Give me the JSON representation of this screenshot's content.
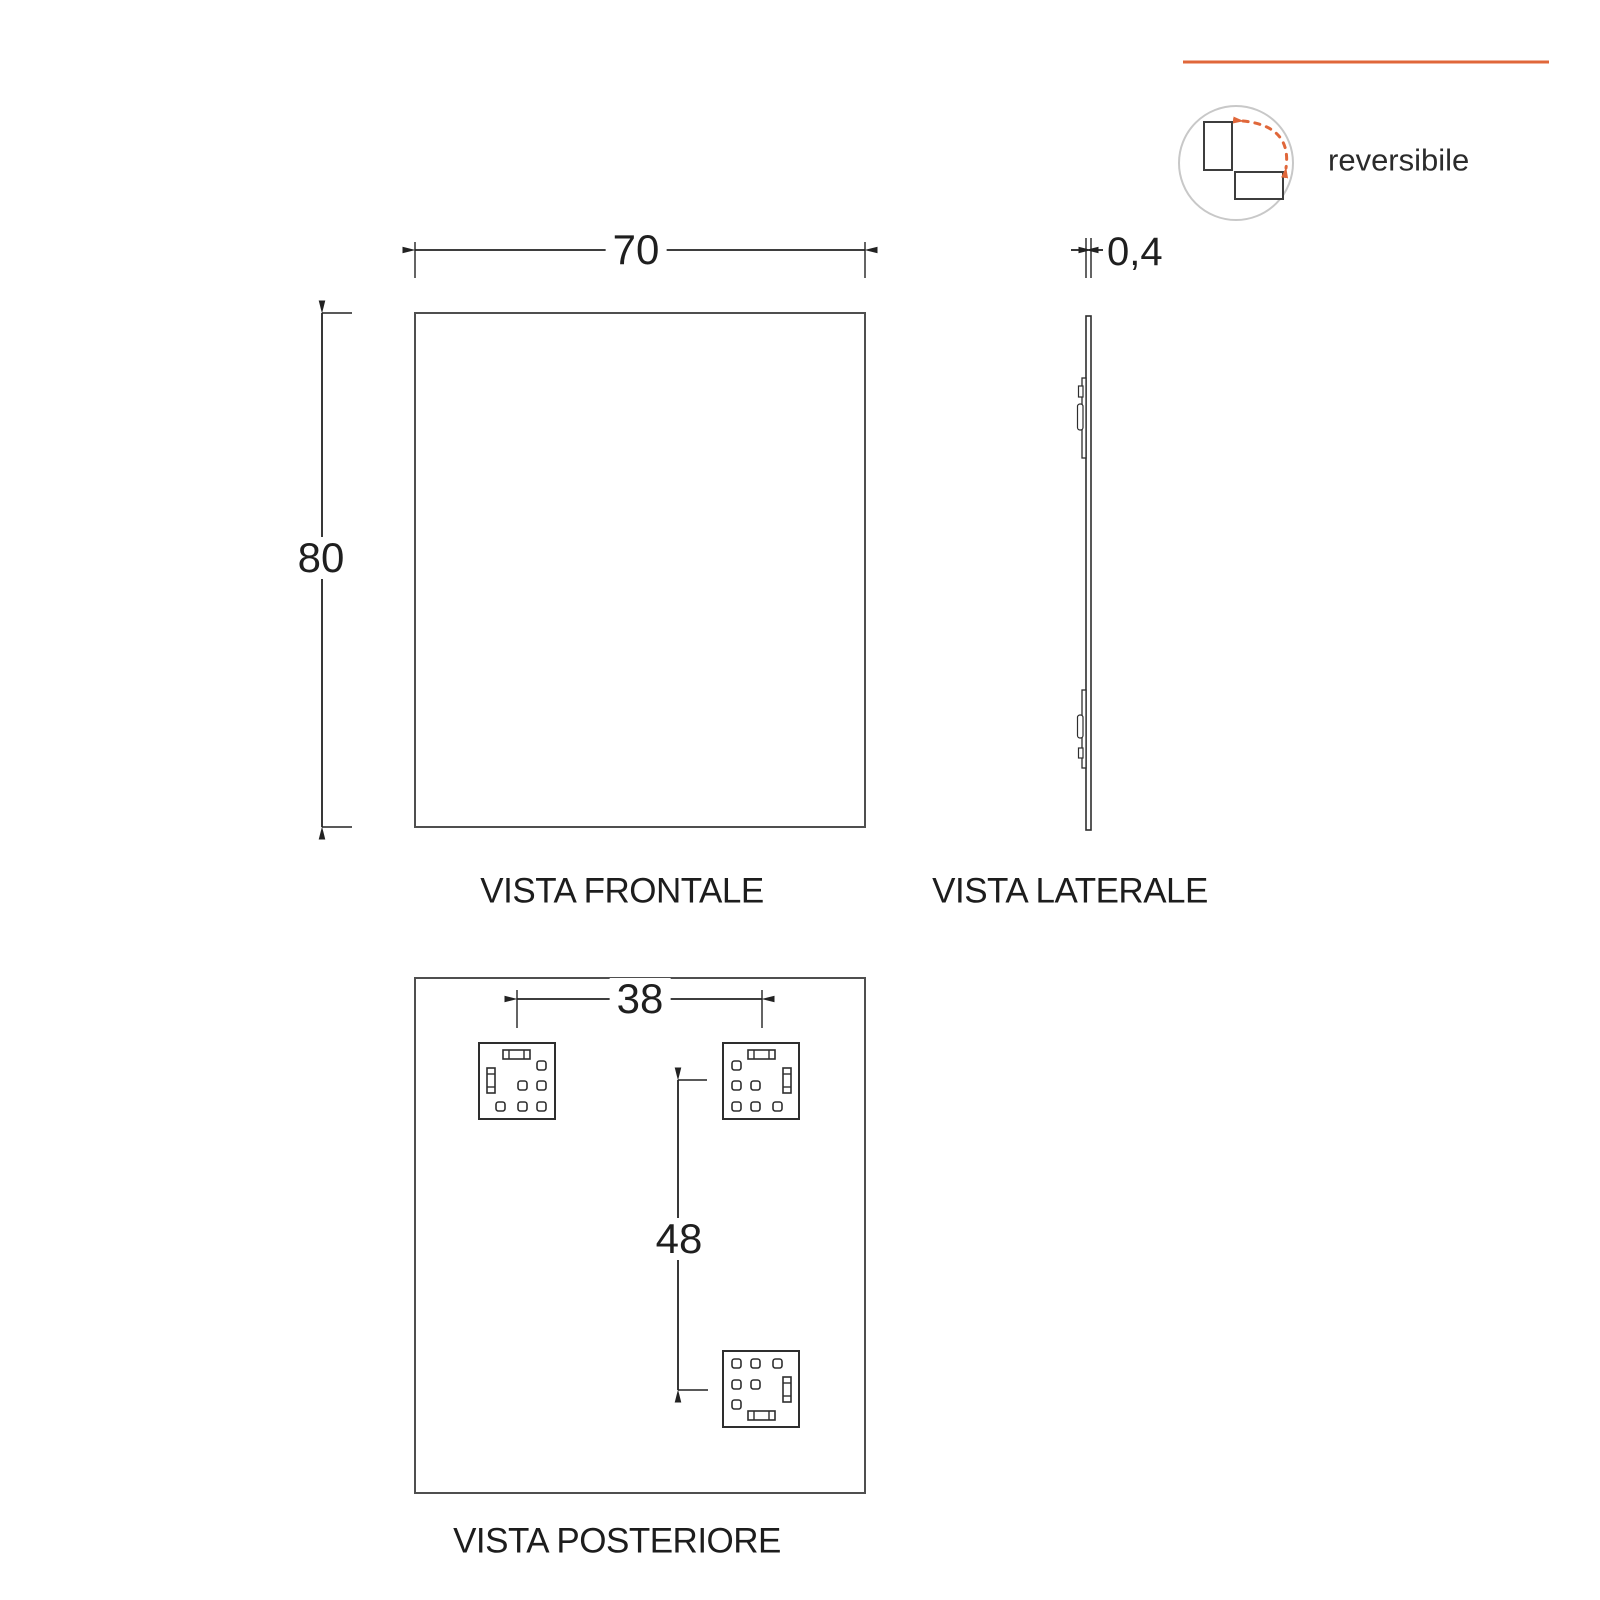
{
  "badge": {
    "label": "reversibile",
    "icon": "reversible-rotation-icon"
  },
  "views": {
    "front": {
      "caption": "VISTA FRONTALE",
      "width_dim": "70",
      "height_dim": "80"
    },
    "side": {
      "caption": "VISTA LATERALE",
      "thickness_dim": "0,4"
    },
    "rear": {
      "caption": "VISTA POSTERIORE",
      "hook_spacing_horizontal_dim": "38",
      "hook_spacing_vertical_dim": "48"
    }
  },
  "colors": {
    "accent_orange": "#E0673A",
    "outline_gray": "#4F4F4F",
    "dimension_black": "#222222",
    "text_black": "#1D1D1D",
    "icon_circle_gray": "#C8C8C8"
  }
}
